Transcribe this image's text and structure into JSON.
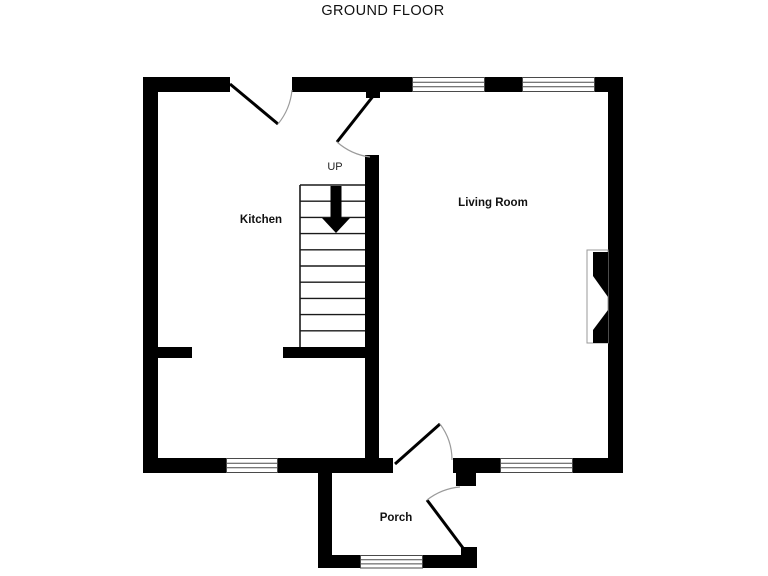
{
  "title": "GROUND FLOOR",
  "rooms": {
    "kitchen": {
      "label": "Kitchen"
    },
    "living_room": {
      "label": "Living Room"
    },
    "porch": {
      "label": "Porch"
    }
  },
  "stairs": {
    "label": "UP",
    "direction": "up",
    "tread_count": 10
  },
  "colors": {
    "background": "#ffffff",
    "wall": "#000000",
    "window_frame": "#4a4a4a",
    "door_leaf": "#000000",
    "swing_arc": "#9b9b9b",
    "text": "#111111"
  }
}
